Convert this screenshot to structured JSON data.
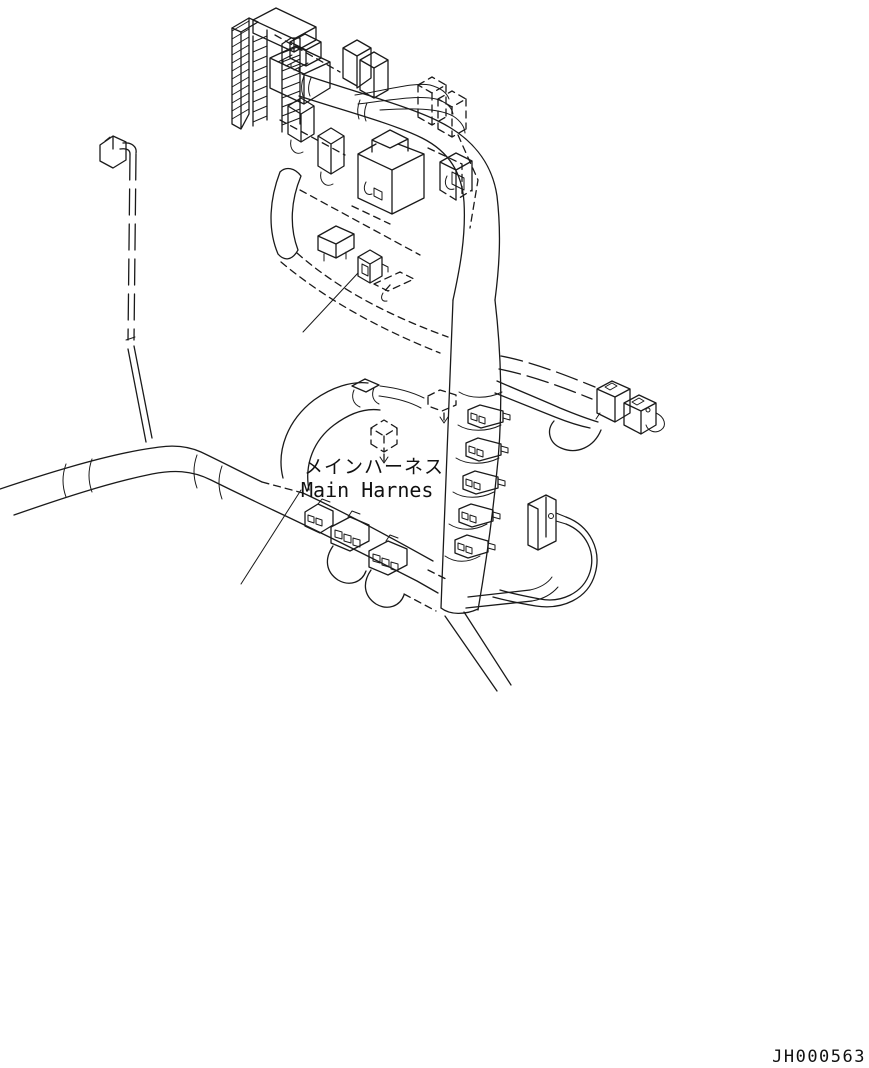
{
  "diagram": {
    "label_jp": "メインハーネス",
    "label_en": "Main Harnes",
    "part_number": "JH000563"
  },
  "style": {
    "background": "#ffffff",
    "line_color": "#1a1a1a",
    "text_color": "#111111"
  },
  "parts": [
    "terminal-block-connector",
    "fuse-box-assembly",
    "relay-cubes",
    "callout-relay",
    "main-harness-trunk",
    "vertical-harness-bundle",
    "clip-connector-stack",
    "tube-mounted-connectors",
    "flat-connector",
    "right-branch-connectors",
    "branch-wire-connector",
    "ghost-connector"
  ]
}
